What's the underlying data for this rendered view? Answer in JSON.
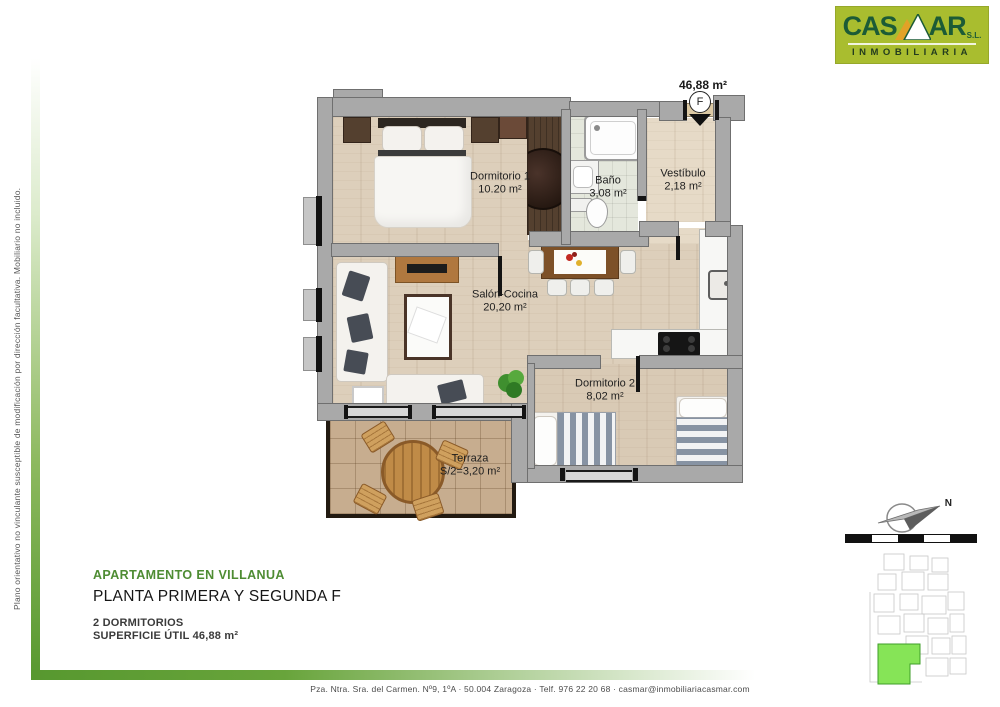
{
  "page": {
    "disclaimer": "Plano orientativo no vinculante susceptible de modificación por dirección facultativa. Mobiliario no incluido.",
    "footer": "Pza. Ntra. Sra. del Carmen. Nº9, 1ºA   ·   50.004 Zaragoza   ·   Telf. 976 22 20 68   ·   casmar@inmobiliariacasmar.com"
  },
  "brand": {
    "name_part1": "CAS",
    "name_part2": "AR",
    "legal_suffix": "S.L.",
    "tagline": "INMOBILIARIA",
    "bg_color": "#a9bd2f",
    "text_color": "#1c5b36"
  },
  "plan": {
    "total_area": "46,88 m²",
    "unit": "F",
    "rooms": [
      {
        "name": "Dormitorio 1",
        "area": "10.20 m²"
      },
      {
        "name": "Baño",
        "area": "3,08 m²"
      },
      {
        "name": "Vestíbulo",
        "area": "2,18 m²"
      },
      {
        "name": "Salón-Cocina",
        "area": "20,20 m²"
      },
      {
        "name": "Dormitorio 2",
        "area": "8,02 m²"
      },
      {
        "name": "Terraza",
        "area": "S/2=3,20 m²"
      }
    ]
  },
  "info": {
    "title": "APARTAMENTO EN VILLANUA",
    "subtitle": "PLANTA PRIMERA Y SEGUNDA F",
    "bedrooms": "2 DORMITORIOS",
    "useful_area": "SUPERFICIE ÚTIL 46,88 m²"
  },
  "sitemap": {
    "north": "N",
    "highlight_color": "#86e457",
    "accent_green": "#5a9e35"
  }
}
